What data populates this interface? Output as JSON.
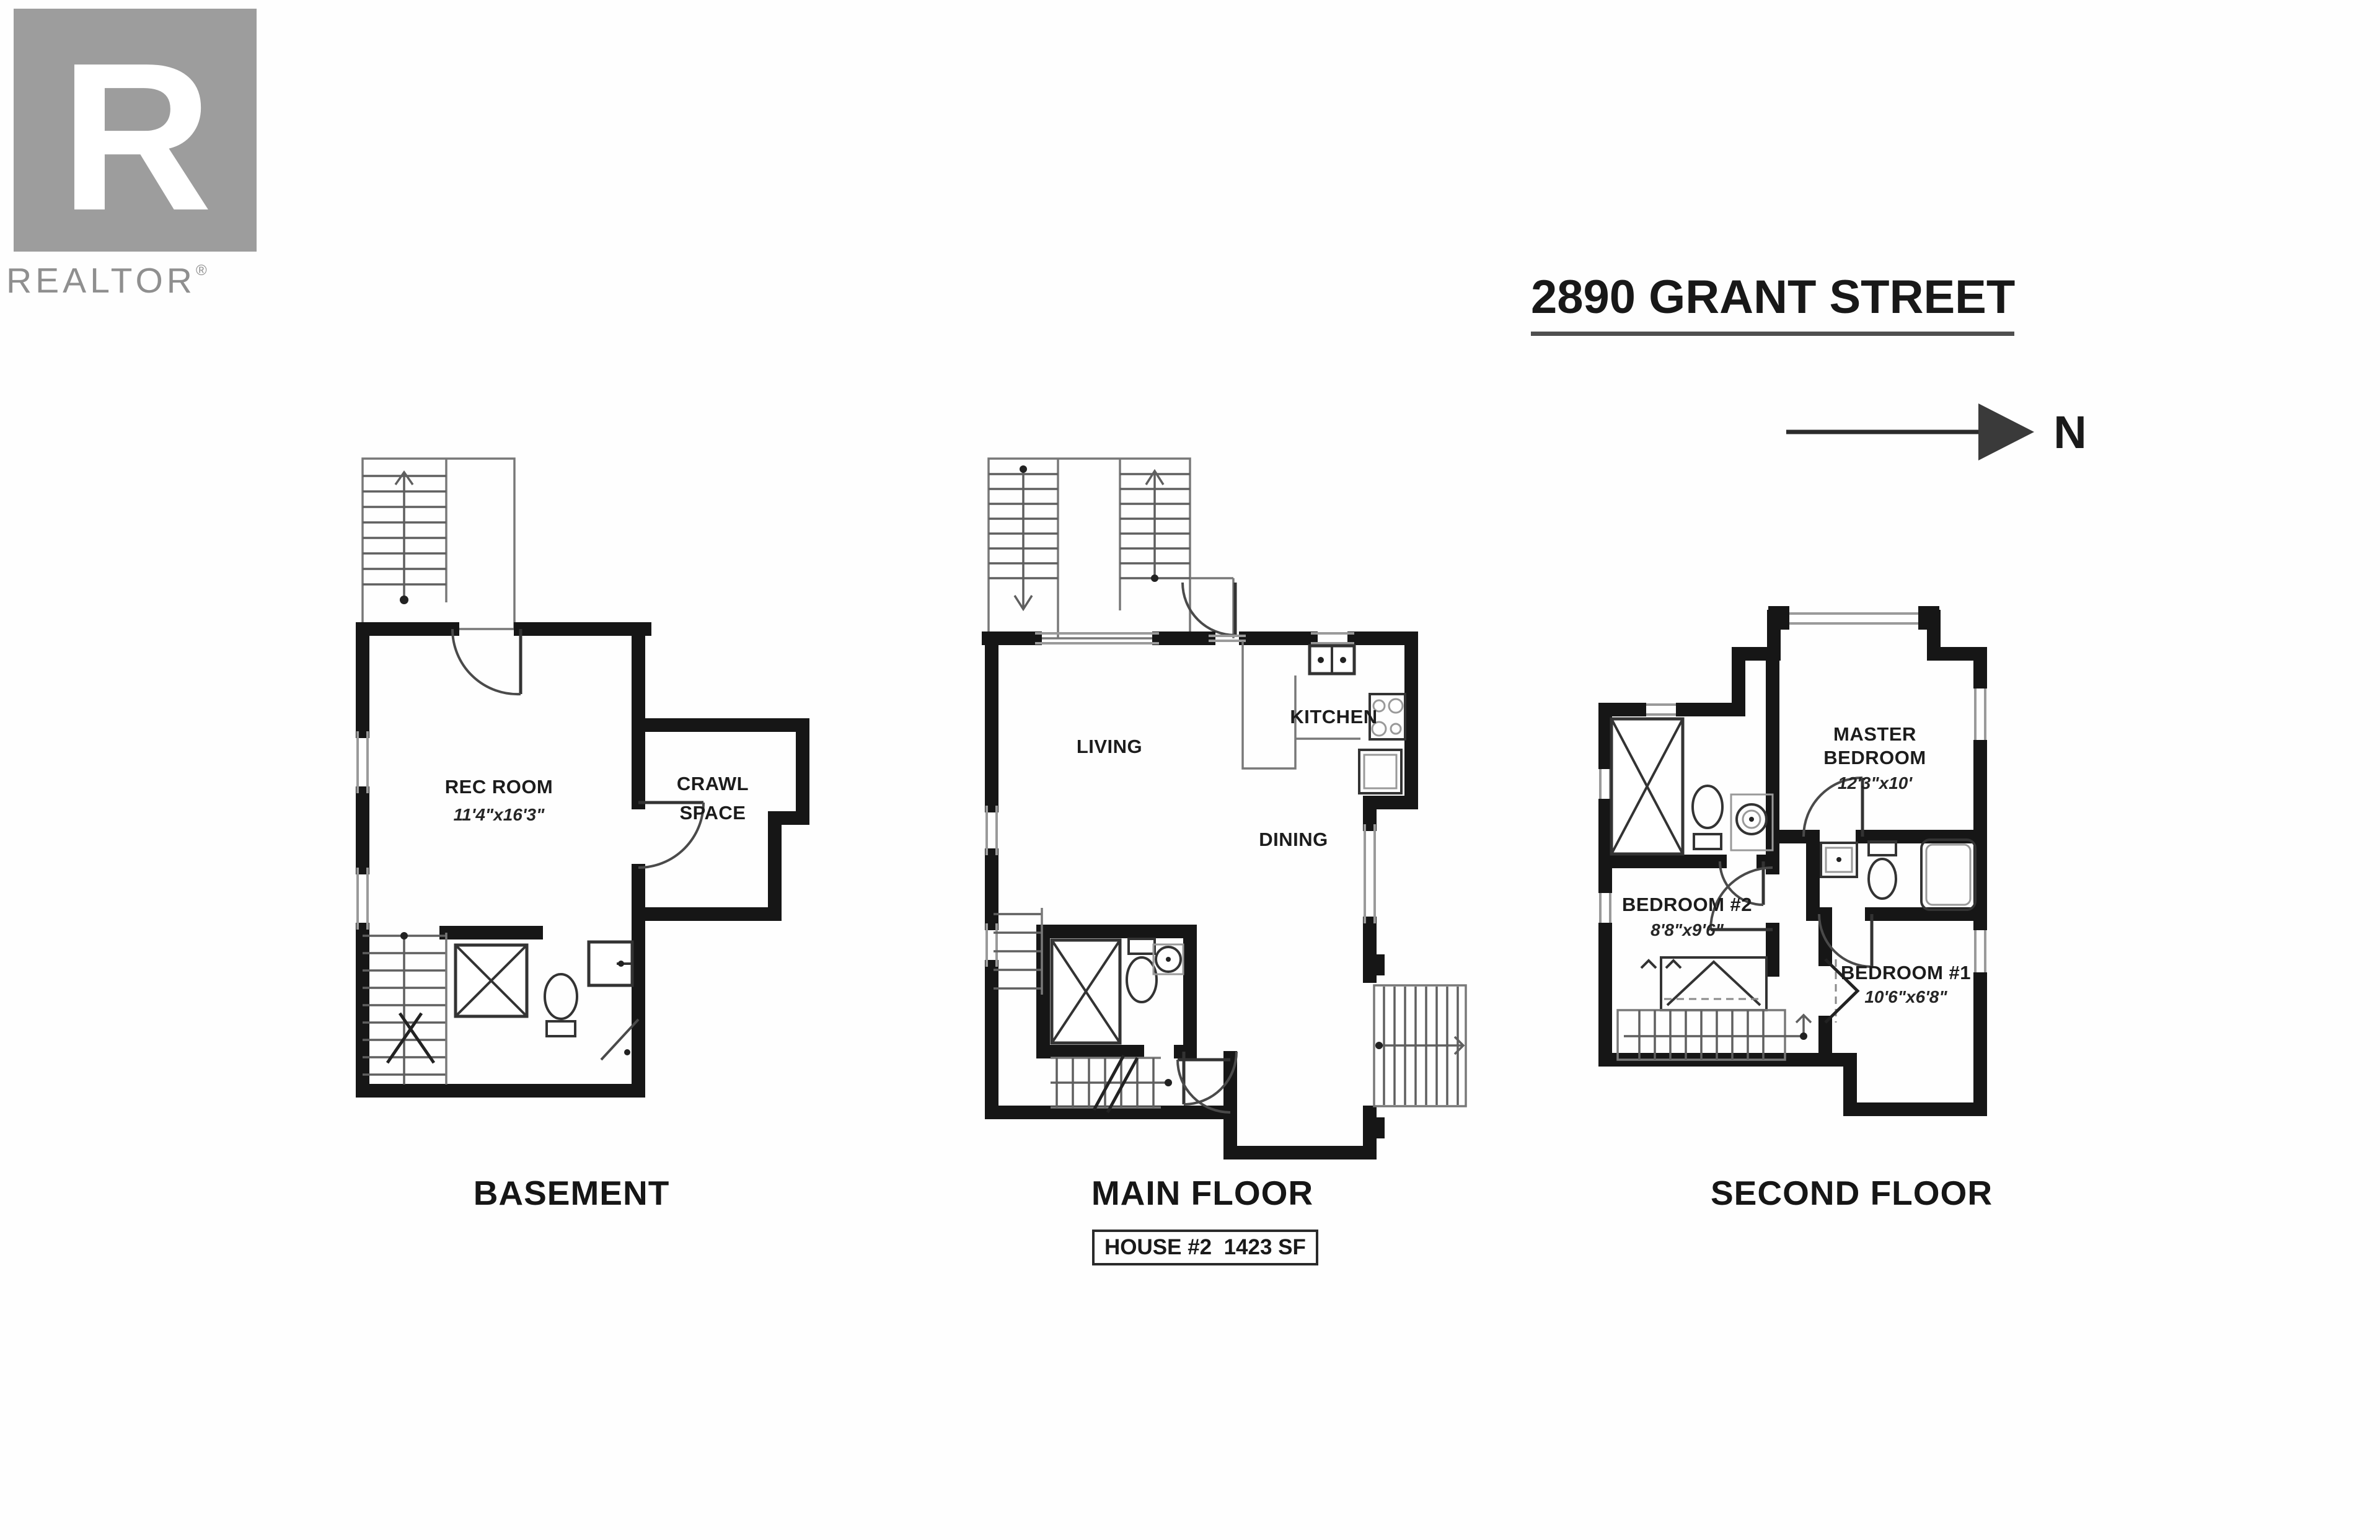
{
  "logo": {
    "letter": "R",
    "brand": "REALTOR",
    "reg": "®"
  },
  "header": {
    "title": "2890 GRANT STREET"
  },
  "compass": {
    "label": "N"
  },
  "plans": {
    "basement": {
      "caption": "BASEMENT",
      "rec_room": {
        "name": "REC ROOM",
        "dims": "11'4\"x16'3\""
      },
      "crawl": {
        "line1": "CRAWL",
        "line2": "SPACE"
      }
    },
    "main": {
      "caption": "MAIN FLOOR",
      "living": "LIVING",
      "kitchen": "KITCHEN",
      "dining": "DINING"
    },
    "second": {
      "caption": "SECOND FLOOR",
      "master": {
        "line1": "MASTER",
        "line2": "BEDROOM",
        "dims": "12'3\"x10'"
      },
      "bedroom2": {
        "name": "BEDROOM #2",
        "dims": "8'8\"x9'6\""
      },
      "bedroom1": {
        "name": "BEDROOM #1",
        "dims": "10'6\"x6'8\""
      }
    }
  },
  "footer": {
    "house_label": "HOUSE #2  1423 SF"
  },
  "colors": {
    "wall": "#161616",
    "logo_gray": "#9d9d9d",
    "ink": "#1c1c1c",
    "accent_underline": "#4f4f4f"
  }
}
